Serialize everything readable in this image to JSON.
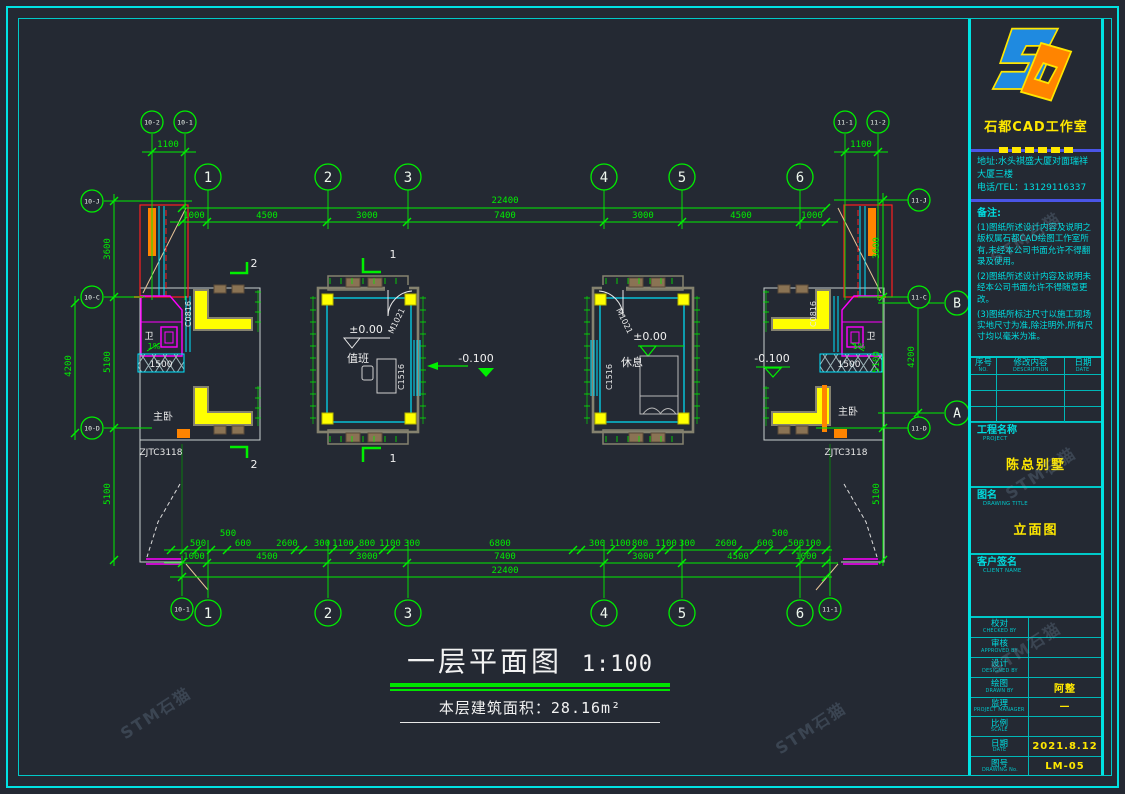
{
  "colors": {
    "background": "#242933",
    "frame_cyan": "#00e2e2",
    "cad_green": "#00ef00",
    "cad_yellow": "#ffff00",
    "cad_magenta": "#ff00ff",
    "cad_orange": "#ff8400",
    "cad_red": "#ff2020",
    "wall_gray": "#85826f"
  },
  "watermark": {
    "text": "STM石猫"
  },
  "title_block": {
    "studio_name": "石都CAD工作室",
    "address_lines": [
      "地址:水头祺盛大厦对面瑞祥",
      "大厦三楼",
      "电话/TEL：13129116337"
    ],
    "notes_title": "备注:",
    "notes": [
      "(1)图纸所述设计内容及说明之版权属石都CAD绘图工作室所有,未经本公司书面允许不得翻录及使用。",
      "(2)图纸所述设计内容及说明未经本公司书面允许不得随意更改。",
      "(3)图纸所标注尺寸以施工现场实地尺寸为准,除注明外,所有尺寸均以毫米为准。"
    ],
    "revision_table": {
      "headers": [
        {
          "zh": "序号",
          "en": "NO."
        },
        {
          "zh": "修改内容",
          "en": "DESCRIPTION"
        },
        {
          "zh": "日期",
          "en": "DATE"
        }
      ],
      "empty_rows": 3
    },
    "project": {
      "zh": "工程名称",
      "en": "PROJECT",
      "value": "陈总别墅"
    },
    "drawing_title": {
      "zh": "图名",
      "en": "DRAWING TITLE",
      "value": "立面图"
    },
    "client": {
      "zh": "客户签名",
      "en": "CLIENT NAME",
      "value": ""
    },
    "signoff_rows": [
      {
        "zh": "校对",
        "en": "CHECKED BY",
        "value": ""
      },
      {
        "zh": "审核",
        "en": "APPROVED BY",
        "value": ""
      },
      {
        "zh": "设计",
        "en": "DESIGNED BY",
        "value": ""
      },
      {
        "zh": "绘图",
        "en": "DRAWN BY",
        "value": "阿整"
      },
      {
        "zh": "监理",
        "en": "PROJECT MANAGER",
        "value": "—"
      },
      {
        "zh": "比例",
        "en": "SCALE",
        "value": ""
      },
      {
        "zh": "日期",
        "en": "DATE",
        "value": "2021.8.12"
      },
      {
        "zh": "图号",
        "en": "DRAWING No.",
        "value": "LM-05"
      }
    ]
  },
  "drawing": {
    "title": "一层平面图",
    "scale": "1:100",
    "area_note": "本层建筑面积：28.16m²",
    "bubbles": [
      {
        "label": "10-2",
        "x": 152,
        "y": 122,
        "r": 11,
        "fs": 6.5
      },
      {
        "label": "10-1",
        "x": 185,
        "y": 122,
        "r": 11,
        "fs": 6.5
      },
      {
        "label": "11-1",
        "x": 845,
        "y": 122,
        "r": 11,
        "fs": 6.5
      },
      {
        "label": "11-2",
        "x": 878,
        "y": 122,
        "r": 11,
        "fs": 6.5
      },
      {
        "label": "1",
        "x": 208,
        "y": 177,
        "r": 13,
        "fs": 14
      },
      {
        "label": "2",
        "x": 328,
        "y": 177,
        "r": 13,
        "fs": 14
      },
      {
        "label": "3",
        "x": 408,
        "y": 177,
        "r": 13,
        "fs": 14
      },
      {
        "label": "4",
        "x": 604,
        "y": 177,
        "r": 13,
        "fs": 14
      },
      {
        "label": "5",
        "x": 682,
        "y": 177,
        "r": 13,
        "fs": 14
      },
      {
        "label": "6",
        "x": 800,
        "y": 177,
        "r": 13,
        "fs": 14
      },
      {
        "label": "10-J",
        "x": 92,
        "y": 201,
        "r": 11,
        "fs": 6.5
      },
      {
        "label": "10-C",
        "x": 92,
        "y": 297,
        "r": 11,
        "fs": 6.5
      },
      {
        "label": "10-D",
        "x": 92,
        "y": 428,
        "r": 11,
        "fs": 6.5
      },
      {
        "label": "11-J",
        "x": 919,
        "y": 200,
        "r": 11,
        "fs": 6.5
      },
      {
        "label": "11-C",
        "x": 919,
        "y": 297,
        "r": 11,
        "fs": 6.5
      },
      {
        "label": "11-D",
        "x": 919,
        "y": 428,
        "r": 11,
        "fs": 6.5
      },
      {
        "label": "B",
        "x": 957,
        "y": 303,
        "r": 12,
        "fs": 13
      },
      {
        "label": "A",
        "x": 957,
        "y": 413,
        "r": 12,
        "fs": 13
      },
      {
        "label": "10-1",
        "x": 182,
        "y": 609,
        "r": 11,
        "fs": 6.5
      },
      {
        "label": "1",
        "x": 208,
        "y": 613,
        "r": 13,
        "fs": 14
      },
      {
        "label": "2",
        "x": 328,
        "y": 613,
        "r": 13,
        "fs": 14
      },
      {
        "label": "3",
        "x": 408,
        "y": 613,
        "r": 13,
        "fs": 14
      },
      {
        "label": "4",
        "x": 604,
        "y": 613,
        "r": 13,
        "fs": 14
      },
      {
        "label": "5",
        "x": 682,
        "y": 613,
        "r": 13,
        "fs": 14
      },
      {
        "label": "6",
        "x": 800,
        "y": 613,
        "r": 13,
        "fs": 14
      },
      {
        "label": "11-1",
        "x": 830,
        "y": 609,
        "r": 11,
        "fs": 6.5
      }
    ],
    "dimensions": [
      {
        "t": "1100",
        "x": 168,
        "y": 147
      },
      {
        "t": "1100",
        "x": 861,
        "y": 147
      },
      {
        "t": "22400",
        "x": 505,
        "y": 203
      },
      {
        "t": "1000",
        "x": 194,
        "y": 218
      },
      {
        "t": "4500",
        "x": 267,
        "y": 218
      },
      {
        "t": "3000",
        "x": 367,
        "y": 218
      },
      {
        "t": "7400",
        "x": 505,
        "y": 218
      },
      {
        "t": "3000",
        "x": 643,
        "y": 218
      },
      {
        "t": "4500",
        "x": 741,
        "y": 218
      },
      {
        "t": "1000",
        "x": 812,
        "y": 218
      },
      {
        "t": "500",
        "x": 198,
        "y": 546
      },
      {
        "t": "500",
        "x": 228,
        "y": 536
      },
      {
        "t": "600",
        "x": 243,
        "y": 546
      },
      {
        "t": "2600",
        "x": 287,
        "y": 546
      },
      {
        "t": "300",
        "x": 322,
        "y": 546
      },
      {
        "t": "1100",
        "x": 343,
        "y": 546
      },
      {
        "t": "800",
        "x": 367,
        "y": 546
      },
      {
        "t": "1100",
        "x": 390,
        "y": 546
      },
      {
        "t": "300",
        "x": 412,
        "y": 546
      },
      {
        "t": "6800",
        "x": 500,
        "y": 546
      },
      {
        "t": "300",
        "x": 597,
        "y": 546
      },
      {
        "t": "1100",
        "x": 620,
        "y": 546
      },
      {
        "t": "800",
        "x": 640,
        "y": 546
      },
      {
        "t": "1100",
        "x": 666,
        "y": 546
      },
      {
        "t": "300",
        "x": 687,
        "y": 546
      },
      {
        "t": "2600",
        "x": 726,
        "y": 546
      },
      {
        "t": "600",
        "x": 765,
        "y": 546
      },
      {
        "t": "500",
        "x": 780,
        "y": 536
      },
      {
        "t": "500",
        "x": 796,
        "y": 546
      },
      {
        "t": "100",
        "x": 813,
        "y": 546
      },
      {
        "t": "1000",
        "x": 194,
        "y": 559
      },
      {
        "t": "4500",
        "x": 267,
        "y": 559
      },
      {
        "t": "3000",
        "x": 367,
        "y": 559
      },
      {
        "t": "7400",
        "x": 505,
        "y": 559
      },
      {
        "t": "3000",
        "x": 643,
        "y": 559
      },
      {
        "t": "4500",
        "x": 738,
        "y": 559
      },
      {
        "t": "1000",
        "x": 806,
        "y": 559
      },
      {
        "t": "22400",
        "x": 505,
        "y": 573
      },
      {
        "t": "3600",
        "x": 110,
        "y": 249,
        "r": -90
      },
      {
        "t": "5100",
        "x": 110,
        "y": 362,
        "r": -90
      },
      {
        "t": "5100",
        "x": 110,
        "y": 494,
        "r": -90
      },
      {
        "t": "4200",
        "x": 71,
        "y": 366,
        "r": -90
      },
      {
        "t": "3600",
        "x": 879,
        "y": 248,
        "r": -90
      },
      {
        "t": "5100",
        "x": 879,
        "y": 362,
        "r": -90
      },
      {
        "t": "5100",
        "x": 879,
        "y": 494,
        "r": -90
      },
      {
        "t": "4200",
        "x": 914,
        "y": 357,
        "r": -90
      }
    ],
    "labels": [
      {
        "t": "ZJTC3118",
        "x": 161,
        "y": 455,
        "c": "#e8e8e8",
        "s": 9
      },
      {
        "t": "ZJTC3118",
        "x": 846,
        "y": 455,
        "c": "#e8e8e8",
        "s": 9
      },
      {
        "t": "C0816",
        "x": 191,
        "y": 314,
        "c": "#e8e8e8",
        "s": 8,
        "r": -90
      },
      {
        "t": "C0816",
        "x": 816,
        "y": 314,
        "c": "#e8e8e8",
        "s": 8,
        "r": -90
      },
      {
        "t": "主卧",
        "x": 163,
        "y": 420,
        "c": "#e8e8e8",
        "s": 10
      },
      {
        "t": "主卧",
        "x": 848,
        "y": 415,
        "c": "#e8e8e8",
        "s": 10
      },
      {
        "t": "卫",
        "x": 149,
        "y": 339,
        "c": "#ffffff",
        "s": 9
      },
      {
        "t": "卫",
        "x": 871,
        "y": 339,
        "c": "#ffffff",
        "s": 9
      },
      {
        "t": "1%",
        "x": 154,
        "y": 349,
        "c": "#00ef00",
        "s": 8
      },
      {
        "t": "1%",
        "x": 859,
        "y": 349,
        "c": "#00ef00",
        "s": 8
      },
      {
        "t": "1500",
        "x": 161,
        "y": 367,
        "c": "#f0f0f0",
        "s": 9
      },
      {
        "t": "1500",
        "x": 849,
        "y": 367,
        "c": "#f0f0f0",
        "s": 9
      },
      {
        "t": "±0.00",
        "x": 366,
        "y": 333,
        "c": "#f0f0f0",
        "s": 11
      },
      {
        "t": "±0.00",
        "x": 650,
        "y": 340,
        "c": "#f0f0f0",
        "s": 11
      },
      {
        "t": "-0.100",
        "x": 476,
        "y": 362,
        "c": "#f0f0f0",
        "s": 11
      },
      {
        "t": "-0.100",
        "x": 772,
        "y": 362,
        "c": "#f0f0f0",
        "s": 11
      },
      {
        "t": "值班",
        "x": 358,
        "y": 362,
        "c": "#f0f0f0",
        "s": 11
      },
      {
        "t": "休息",
        "x": 632,
        "y": 366,
        "c": "#f0f0f0",
        "s": 11
      },
      {
        "t": "M1021",
        "x": 399,
        "y": 322,
        "c": "#e8e8e8",
        "s": 8,
        "r": -64
      },
      {
        "t": "M1021",
        "x": 622,
        "y": 322,
        "c": "#e8e8e8",
        "s": 8,
        "r": 64
      },
      {
        "t": "C1516",
        "x": 404,
        "y": 377,
        "c": "#e8e8e8",
        "s": 8,
        "r": -90
      },
      {
        "t": "C1516",
        "x": 612,
        "y": 377,
        "c": "#e8e8e8",
        "s": 8,
        "r": -90
      },
      {
        "t": "2",
        "x": 254,
        "y": 267,
        "c": "#f0f0f0",
        "s": 11
      },
      {
        "t": "2",
        "x": 254,
        "y": 468,
        "c": "#f0f0f0",
        "s": 11
      },
      {
        "t": "1",
        "x": 393,
        "y": 258,
        "c": "#f0f0f0",
        "s": 11
      },
      {
        "t": "1",
        "x": 393,
        "y": 462,
        "c": "#f0f0f0",
        "s": 11
      }
    ]
  }
}
